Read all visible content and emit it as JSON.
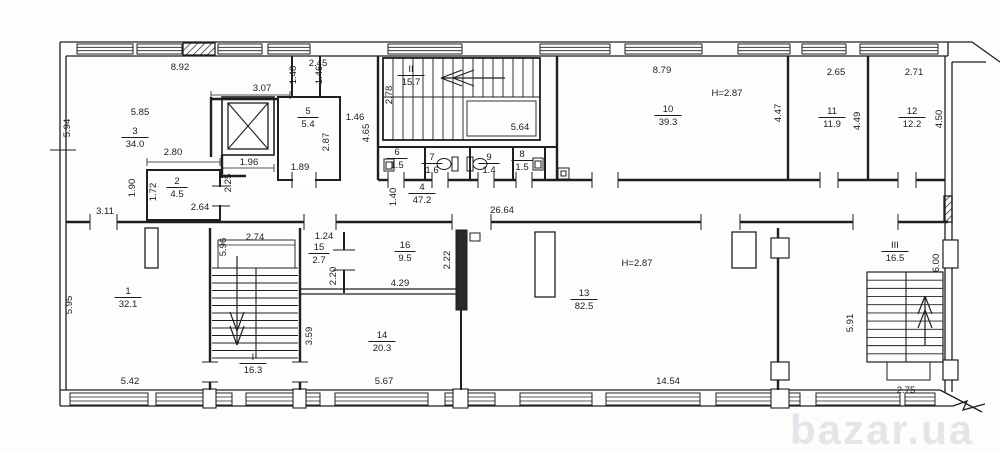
{
  "drawing": {
    "type": "apartment-building floor plan",
    "ceiling_height_note": "H=2.87"
  },
  "rooms": [
    {
      "number": "3",
      "area": "34.0",
      "x": 135,
      "y": 134
    },
    {
      "number": "2",
      "area": "4.5",
      "x": 177,
      "y": 184
    },
    {
      "number": "5",
      "area": "5.4",
      "x": 308,
      "y": 114
    },
    {
      "number": "II",
      "area": "15.7",
      "x": 411,
      "y": 72
    },
    {
      "number": "6",
      "area": "1.5",
      "x": 397,
      "y": 155
    },
    {
      "number": "7",
      "area": "1.6",
      "x": 432,
      "y": 160
    },
    {
      "number": "9",
      "area": "1.4",
      "x": 489,
      "y": 160
    },
    {
      "number": "8",
      "area": "1.5",
      "x": 522,
      "y": 157
    },
    {
      "number": "4",
      "area": "47.2",
      "x": 422,
      "y": 190
    },
    {
      "number": "10",
      "area": "39.3",
      "x": 668,
      "y": 112
    },
    {
      "number": "11",
      "area": "11.9",
      "x": 832,
      "y": 114
    },
    {
      "number": "12",
      "area": "12.2",
      "x": 912,
      "y": 114
    },
    {
      "number": "1",
      "area": "32.1",
      "x": 128,
      "y": 294
    },
    {
      "number": "I",
      "area": "16.3",
      "x": 253,
      "y": 360
    },
    {
      "number": "15",
      "area": "2.7",
      "x": 319,
      "y": 250
    },
    {
      "number": "16",
      "area": "9.5",
      "x": 405,
      "y": 248
    },
    {
      "number": "14",
      "area": "20.3",
      "x": 382,
      "y": 338
    },
    {
      "number": "13",
      "area": "82.5",
      "x": 584,
      "y": 296
    },
    {
      "number": "III",
      "area": "16.5",
      "x": 895,
      "y": 248
    }
  ],
  "dimensions": [
    {
      "t": "8.92",
      "x": 180,
      "y": 70
    },
    {
      "t": "5.94",
      "x": 70,
      "y": 128,
      "r": -90
    },
    {
      "t": "5.85",
      "x": 140,
      "y": 115
    },
    {
      "t": "2.80",
      "x": 173,
      "y": 155
    },
    {
      "t": "3.07",
      "x": 262,
      "y": 91
    },
    {
      "t": "2.45",
      "x": 318,
      "y": 66
    },
    {
      "t": "1.48",
      "x": 296,
      "y": 75,
      "r": -90
    },
    {
      "t": "1.46",
      "x": 322,
      "y": 75,
      "r": -90
    },
    {
      "t": "1.46",
      "x": 355,
      "y": 120
    },
    {
      "t": "2.87",
      "x": 329,
      "y": 142,
      "r": -90
    },
    {
      "t": "1.89",
      "x": 300,
      "y": 170
    },
    {
      "t": "1.96",
      "x": 249,
      "y": 165
    },
    {
      "t": "2.25",
      "x": 231,
      "y": 183,
      "r": -90
    },
    {
      "t": "1.90",
      "x": 135,
      "y": 188,
      "r": -90
    },
    {
      "t": "1.72",
      "x": 156,
      "y": 192,
      "r": -90
    },
    {
      "t": "3.11",
      "x": 105,
      "y": 214
    },
    {
      "t": "2.64",
      "x": 200,
      "y": 210
    },
    {
      "t": "2.78",
      "x": 392,
      "y": 95,
      "r": -90
    },
    {
      "t": "4.65",
      "x": 369,
      "y": 133,
      "r": -90
    },
    {
      "t": "5.64",
      "x": 520,
      "y": 130
    },
    {
      "t": "1.40",
      "x": 396,
      "y": 197,
      "r": -90
    },
    {
      "t": "26.64",
      "x": 502,
      "y": 213
    },
    {
      "t": "8.79",
      "x": 662,
      "y": 73
    },
    {
      "t": "H=2.87",
      "x": 727,
      "y": 96
    },
    {
      "t": "4.47",
      "x": 781,
      "y": 113,
      "r": -90
    },
    {
      "t": "2.65",
      "x": 836,
      "y": 75
    },
    {
      "t": "4.49",
      "x": 860,
      "y": 121,
      "r": -90
    },
    {
      "t": "2.71",
      "x": 914,
      "y": 75
    },
    {
      "t": "4.50",
      "x": 942,
      "y": 119,
      "r": -90
    },
    {
      "t": "5.95",
      "x": 72,
      "y": 305,
      "r": -90
    },
    {
      "t": "5.42",
      "x": 130,
      "y": 384
    },
    {
      "t": "2.74",
      "x": 255,
      "y": 240
    },
    {
      "t": "5.96",
      "x": 226,
      "y": 247,
      "r": -90
    },
    {
      "t": "1.24",
      "x": 324,
      "y": 239
    },
    {
      "t": "2.20",
      "x": 336,
      "y": 276,
      "r": -90
    },
    {
      "t": "4.29",
      "x": 400,
      "y": 286
    },
    {
      "t": "2.22",
      "x": 450,
      "y": 260,
      "r": -90
    },
    {
      "t": "3.59",
      "x": 312,
      "y": 336,
      "r": -90
    },
    {
      "t": "5.67",
      "x": 384,
      "y": 384
    },
    {
      "t": "H=2.87",
      "x": 637,
      "y": 266
    },
    {
      "t": "14.54",
      "x": 668,
      "y": 384
    },
    {
      "t": "5.91",
      "x": 853,
      "y": 323,
      "r": -90
    },
    {
      "t": "6.00",
      "x": 939,
      "y": 263,
      "r": -90
    },
    {
      "t": "2.75",
      "x": 906,
      "y": 393
    }
  ],
  "watermark": {
    "text": "bazar.ua",
    "x": 790,
    "y": 444
  }
}
